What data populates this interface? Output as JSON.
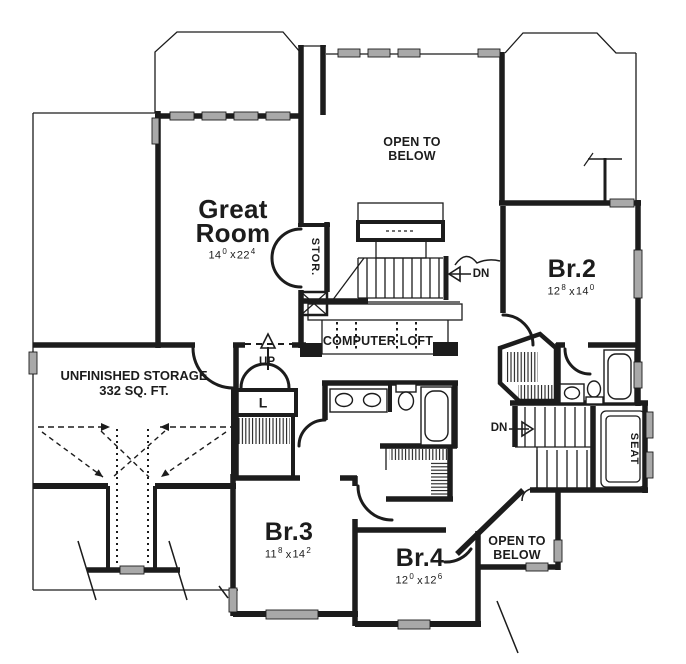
{
  "style": {
    "background": "#ffffff",
    "line_color": "#1c1c1c",
    "window_fill": "#a9a9a9"
  },
  "rooms": {
    "great_room": {
      "name": "Great Room",
      "dim": {
        "a": "14",
        "a_sup": "0",
        "sep": "x",
        "b": "22",
        "b_sup": "4"
      }
    },
    "br2": {
      "name": "Br.2",
      "dim": {
        "a": "12",
        "a_sup": "8",
        "sep": "x",
        "b": "14",
        "b_sup": "0"
      }
    },
    "br3": {
      "name": "Br.3",
      "dim": {
        "a": "11",
        "a_sup": "8",
        "sep": "x",
        "b": "14",
        "b_sup": "2"
      }
    },
    "br4": {
      "name": "Br.4",
      "dim": {
        "a": "12",
        "a_sup": "0",
        "sep": "x",
        "b": "12",
        "b_sup": "6"
      }
    }
  },
  "areas": {
    "open_to_below_top": "OPEN TO BELOW",
    "open_to_below_bottom": "OPEN TO BELOW",
    "computer_loft": "COMPUTER LOFT",
    "unfinished_storage": {
      "line1": "UNFINISHED STORAGE",
      "line2": "332 SQ. FT."
    },
    "storage_closet": "STOR.",
    "linen_closet": "L",
    "window_seat": "SEAT"
  },
  "stairs": {
    "up": "UP",
    "down_upper": "DN",
    "down_main": "DN"
  }
}
